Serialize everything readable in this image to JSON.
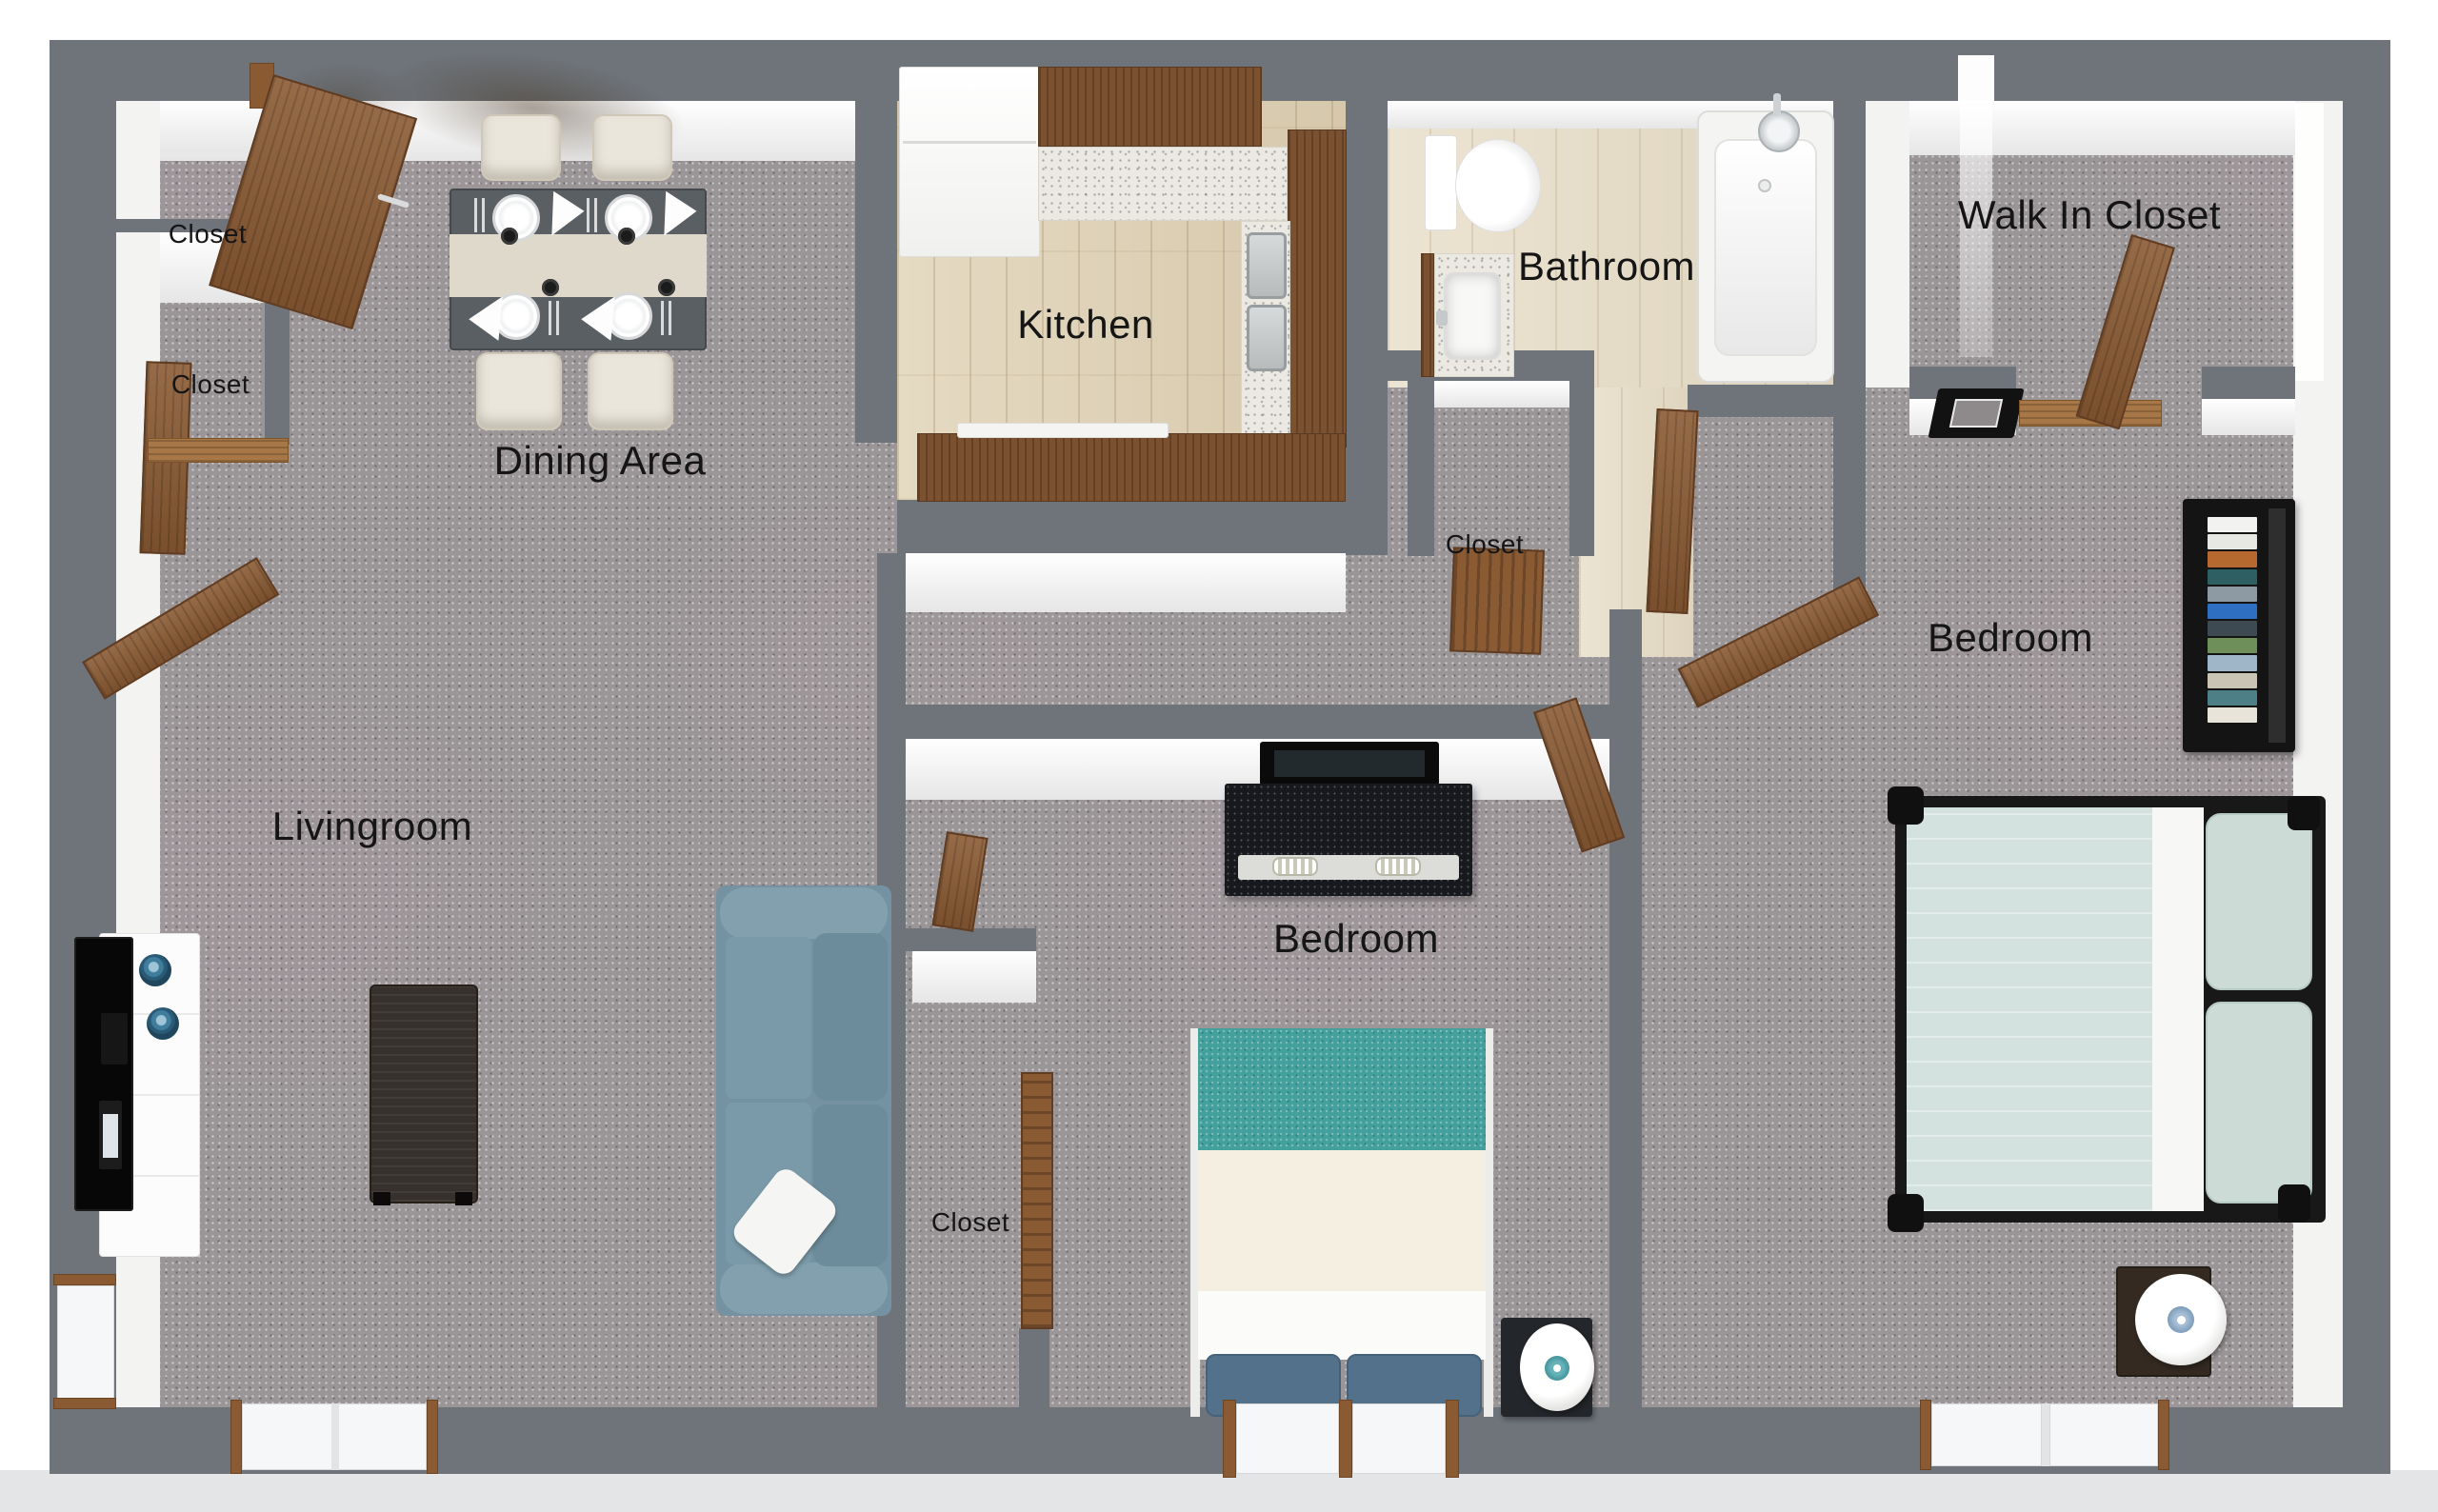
{
  "meta": {
    "type": "3d-floor-plan-render",
    "view": "top-down 3D apartment floor plan, two bedrooms one bathroom"
  },
  "labels": {
    "dining_area": "Dining Area",
    "kitchen": "Kitchen",
    "bathroom": "Bathroom",
    "walk_in_closet": "Walk In Closet",
    "bedroom_right": "Bedroom",
    "bedroom_middle": "Bedroom",
    "livingroom": "Livingroom",
    "closet_upper_left": "Closet",
    "closet_lower_left": "Closet",
    "closet_hallway": "Closet",
    "closet_middle": "Closet"
  },
  "palette": {
    "wall": "#6F747A",
    "wall_face": "#F5F5F4",
    "carpet": "#9A9597",
    "kitchen_floor": "#DDD0B5",
    "bathroom_floor": "#E6DECB",
    "cabinet_wood": "#7B5130",
    "door_wood": "#8A5A33",
    "threshold_wood": "#A87747",
    "counter": "#EBE9E2",
    "dining_table": "#5A5F63",
    "table_runner": "#DED9CB",
    "chair": "#EAE6DB",
    "sofa": "#7492A1",
    "coffee_table": "#37312D",
    "tv_console": "#FCFCFC",
    "tv": "#0B0B0B",
    "decor_bowl_blue": "#3F7D9C",
    "duvet_mint": "#D3E2DE",
    "duvet_teal": "#44A09C",
    "sheet_cream": "#F4EFE1",
    "pillow_navy": "#54718C",
    "dresser": "#17191E",
    "bookshelf": "#141414",
    "lamp_accent_teal": "#3F8F96",
    "lamp_accent_blue": "#7D9CBA",
    "exterior_slab": "#E3E5E7",
    "label_text": "#151515"
  },
  "books": [
    "#F2F2F0",
    "#E7E7E3",
    "#B5692F",
    "#2D5F63",
    "#8D9AA3",
    "#2F6FC2",
    "#3E4A52",
    "#6F8F5A",
    "#9FB6C8",
    "#C9C4B4",
    "#4D7F86",
    "#E8E4DA"
  ]
}
